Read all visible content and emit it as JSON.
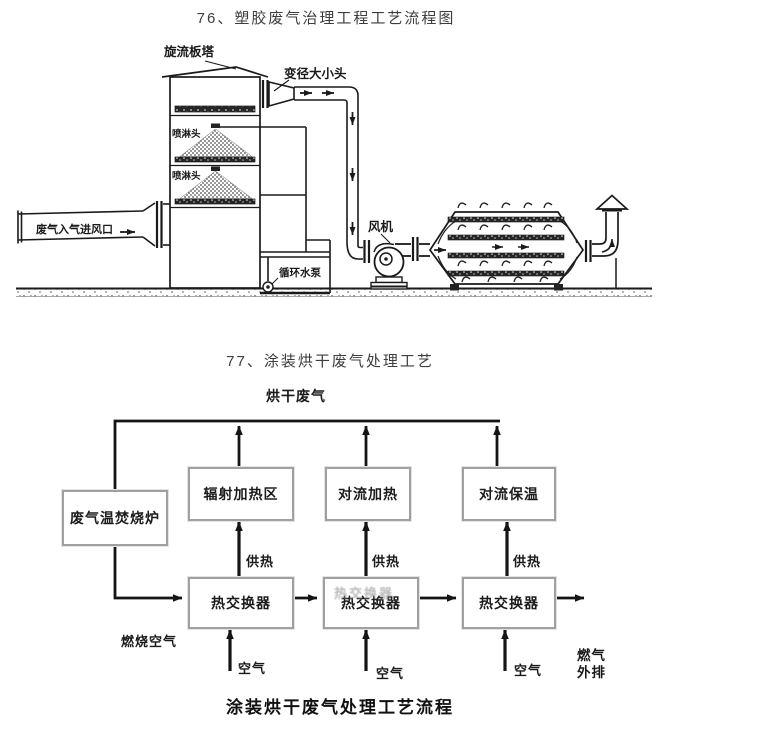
{
  "colors": {
    "line": "#1a1a1a",
    "flow_line": "#151515",
    "box_border": "#a0a0a0",
    "title_text": "#3d3d3d",
    "label_text": "#1a1a1a"
  },
  "d76": {
    "title": "76、塑胶废气治理工程工艺流程图",
    "labels": {
      "tower": "旋流板塔",
      "reducer": "变径大小头",
      "spray1": "喷淋头",
      "spray2": "喷淋头",
      "inlet": "废气入气进风口",
      "pump": "循环水泵",
      "fan": "风机"
    }
  },
  "d77": {
    "title": "77、涂装烘干废气处理工艺",
    "top_label": "烘干废气",
    "boxes": {
      "incinerator": "废气温焚烧炉",
      "radiant": "辐射加热区",
      "conv_heat": "对流加热",
      "conv_hold": "对流保温",
      "hx1": "热交换器",
      "hx2": "热交换器",
      "hx2_ghost": "热交换器",
      "hx3": "热交换器"
    },
    "labels": {
      "supply1": "供热",
      "supply2": "供热",
      "supply3": "供热",
      "combustion_air": "燃烧空气",
      "air1": "空气",
      "air2": "空气",
      "air3": "空气",
      "exhaust_line1": "燃气",
      "exhaust_line2": "外排"
    },
    "caption": "涂装烘干废气处理工艺流程"
  }
}
